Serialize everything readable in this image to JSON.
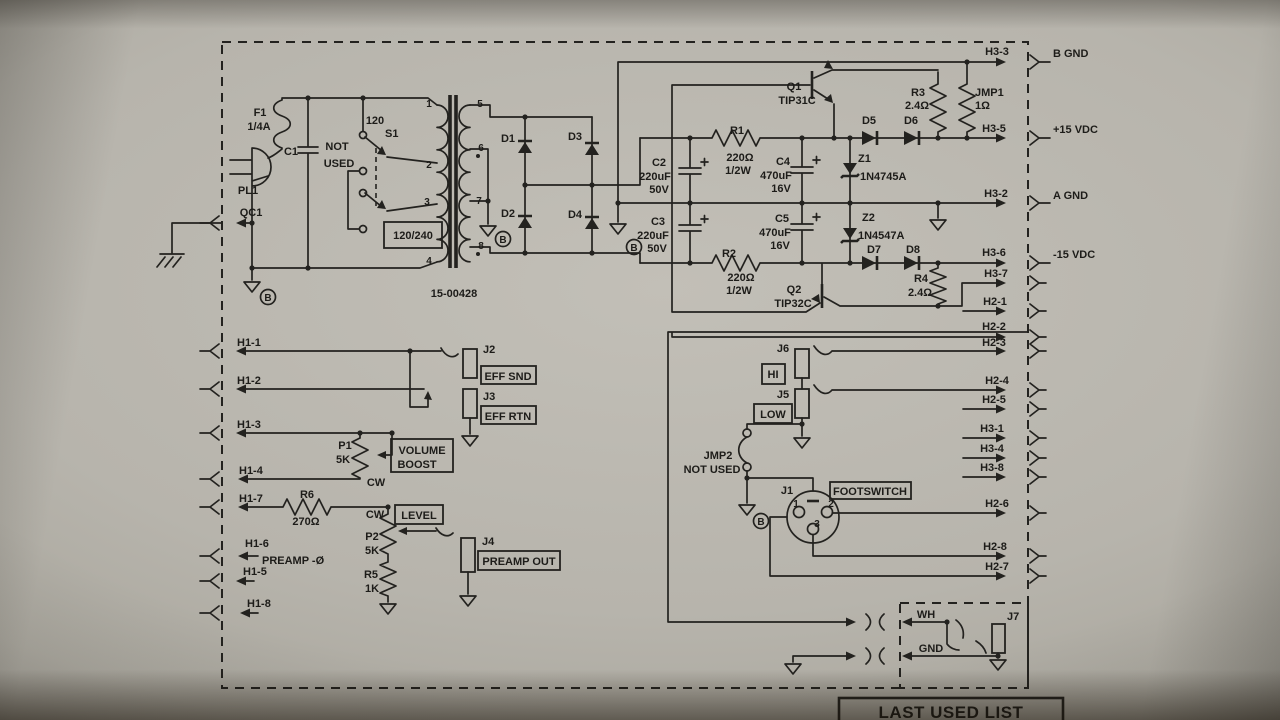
{
  "ac_input": {
    "pl1": "PL1",
    "qc1": "QC1",
    "f1": "F1",
    "f1_value": "1/4A",
    "c1": "C1",
    "not": "NOT",
    "used": "USED",
    "s1": "S1",
    "s1_120": "120",
    "selector": "120/240",
    "gnd_b": "B"
  },
  "transformer": {
    "part": "15-00428",
    "p1": "1",
    "p2": "2",
    "p3": "3",
    "p4": "4",
    "p5": "5",
    "p6": "6",
    "p7": "7",
    "p8": "8",
    "gnd_b": "B"
  },
  "rectifier": {
    "d1": "D1",
    "d2": "D2",
    "d3": "D3",
    "d4": "D4",
    "gnd_b": "B"
  },
  "filter": {
    "c2": "C2",
    "c2_uf": "220uF",
    "c2_v": "50V",
    "c3": "C3",
    "c3_uf": "220uF",
    "c3_v": "50V",
    "c4": "C4",
    "c4_uf": "470uF",
    "c4_v": "16V",
    "c5": "C5",
    "c5_uf": "470uF",
    "c5_v": "16V",
    "r1": "R1",
    "r1_ohm": "220Ω",
    "r1_w": "1/2W",
    "r2": "R2",
    "r2_ohm": "220Ω",
    "r2_w": "1/2W"
  },
  "regulator": {
    "q1": "Q1",
    "q1_part": "TIP31C",
    "q2": "Q2",
    "q2_part": "TIP32C",
    "z1": "Z1",
    "z1_part": "1N4745A",
    "z2": "Z2",
    "z2_part": "1N4547A",
    "d5": "D5",
    "d6": "D6",
    "d7": "D7",
    "d8": "D8",
    "r3": "R3",
    "r3_ohm": "2.4Ω",
    "r4": "R4",
    "r4_ohm": "2.4Ω",
    "jmp1": "JMP1",
    "jmp1_ohm": "1Ω"
  },
  "harness_right": {
    "h3_3": "H3-3",
    "b_gnd": "B GND",
    "h3_5": "H3-5",
    "p15": "+15 VDC",
    "h3_2": "H3-2",
    "a_gnd": "A GND",
    "h3_6": "H3-6",
    "m15": "-15 VDC",
    "h3_7": "H3-7",
    "h2_1": "H2-1",
    "h2_2": "H2-2",
    "h2_3": "H2-3",
    "h2_4": "H2-4",
    "h2_5": "H2-5",
    "h3_1": "H3-1",
    "h3_4": "H3-4",
    "h3_8": "H3-8",
    "h2_6": "H2-6",
    "h2_8": "H2-8",
    "h2_7": "H2-7"
  },
  "harness_left": {
    "h1_1": "H1-1",
    "h1_2": "H1-2",
    "h1_3": "H1-3",
    "h1_4": "H1-4",
    "h1_7": "H1-7",
    "h1_6": "H1-6",
    "preamp": "PREAMP -Ø",
    "h1_5": "H1-5",
    "h1_8": "H1-8"
  },
  "preamp": {
    "j2": "J2",
    "eff_snd": "EFF SND",
    "j3": "J3",
    "eff_rtn": "EFF RTN",
    "p1": "P1",
    "p1_val": "5K",
    "cw1": "CW",
    "volume": "VOLUME",
    "boost": "BOOST",
    "r6": "R6",
    "r6_ohm": "270Ω",
    "cw2": "CW",
    "level": "LEVEL",
    "p2": "P2",
    "p2_val": "5K",
    "r5": "R5",
    "r5_val": "1K",
    "j4": "J4",
    "preamp_out": "PREAMP OUT"
  },
  "channel": {
    "j6": "J6",
    "hi": "HI",
    "j5": "J5",
    "low": "LOW",
    "jmp2": "JMP2",
    "not_used": "NOT USED",
    "gnd_b": "B",
    "j1": "J1",
    "footswitch": "FOOTSWITCH",
    "pin1": "1",
    "pin2": "2",
    "pin3": "3"
  },
  "output": {
    "wh": "WH",
    "gnd": "GND",
    "j7": "J7"
  },
  "footer": {
    "last_used": "LAST USED LIST"
  }
}
